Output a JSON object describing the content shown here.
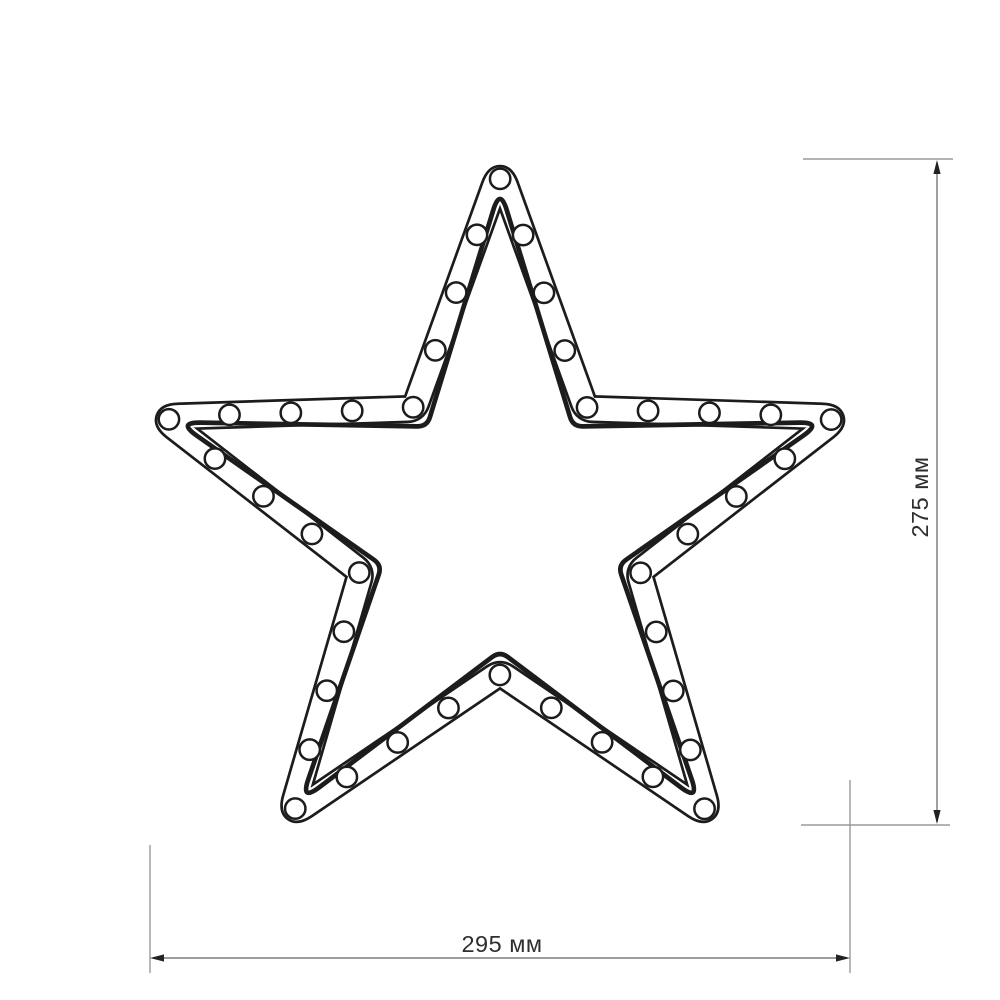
{
  "figure": {
    "type": "dimensional-diagram",
    "object": "five-point LED star frame with round bulbs",
    "background": "#ffffff",
    "line_color": "#1c1c1c",
    "dimension_line_color": "#8f8f8f",
    "extension_line_color": "#9a9a9a",
    "arrow_color": "#222222",
    "label_color": "#2e2e2e",
    "star": {
      "points": 5,
      "center_x": 500,
      "center_y": 527,
      "tip_radius": 356,
      "notch_radius": 146,
      "channel_width": 25.5,
      "outline_stroke": 2.7,
      "inner_edge_offset": 19,
      "inner_edge_stroke": 4.7,
      "tip_corner_radius": 6,
      "notch_corner_radius": 10,
      "bulbs": {
        "count": 40,
        "radius": 10.2,
        "stroke": 2.5
      }
    },
    "dimensions": {
      "height": {
        "label": "275 мм",
        "value": 275,
        "unit": "мм"
      },
      "width": {
        "label": "295 мм",
        "value": 295,
        "unit": "мм"
      }
    }
  }
}
